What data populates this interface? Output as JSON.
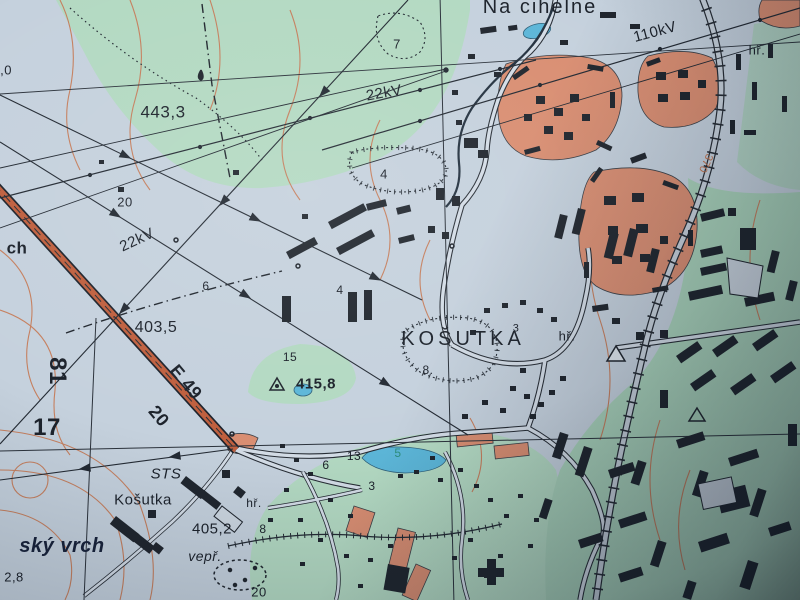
{
  "map": {
    "description": "photograph of Czech topographic paper map, Košutka area",
    "labels": {
      "na_cihelne": "Na cihelne",
      "kv110": "110kV",
      "hr_top_right": "hř.",
      "v443": "443,3",
      "pit7": "7",
      "kv22_top": "22kV",
      "pit4": "4",
      "contour370": "370",
      "n20_top": "20",
      "kv22_left": "22kV",
      "ch": "ch",
      "n0_edge": ",0",
      "boundary6": "6",
      "v403": "403,5",
      "grid81": "81",
      "route_e49": "E 49",
      "route20": "20",
      "grid17": "17",
      "n4_center": "4",
      "n15": "15",
      "v415": "415,8",
      "kosutka_big": "KOŠUTKA",
      "kosutka_sup": "3",
      "hr_mid": "hř.",
      "pit8": "8.",
      "sts": "STS",
      "kosutka_small": "Košutka",
      "hr_bottom": "hř.",
      "v405": "405,2",
      "n8_bottom": "8",
      "n6_village": "6",
      "n13": "13",
      "n3": "3",
      "n5_pond": "5",
      "sky_vrch": "ský vrch",
      "v2_8": "2,8",
      "vepr": "vepř.",
      "n20_bottom": "20"
    }
  },
  "colors": {
    "paper": "#c5d1dd",
    "green": "#b3d9c2",
    "green2": "#a9d2ba",
    "builtup": "#d98e72",
    "water": "#5cb6d8",
    "roadfill": "#bf5f3e",
    "roadwhite": "#d3dce6",
    "bldg": "#20262e",
    "ink": "#1c222b",
    "contour": "#c57f5e",
    "contour_label": "#c0734f",
    "teal_label": "#2e8f7e",
    "navy_text": "#18223a"
  }
}
